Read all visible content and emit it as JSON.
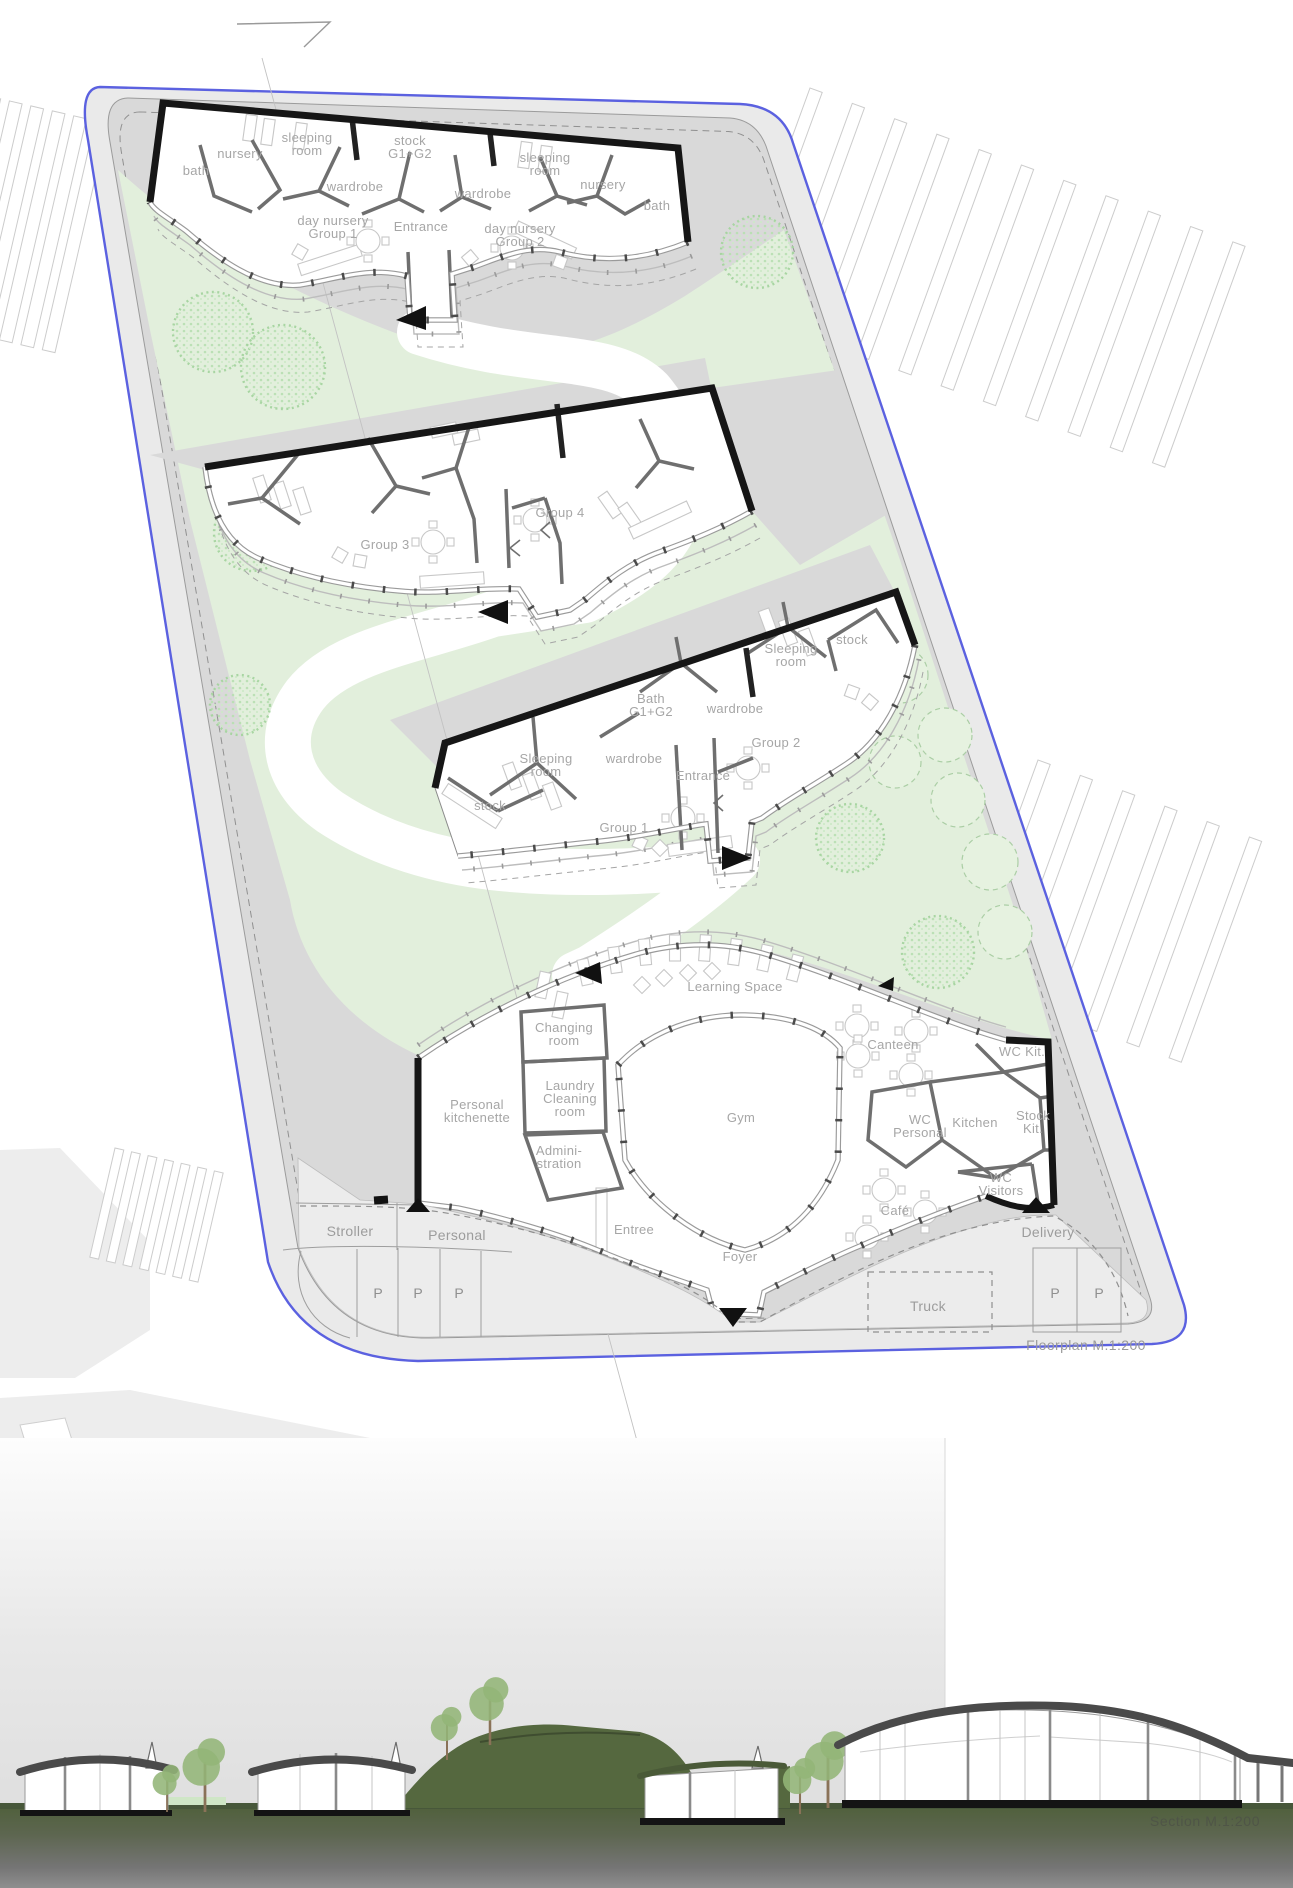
{
  "plan": {
    "scale_label": "Floorplan M.1:200",
    "b1": {
      "bath_l": "bath",
      "nursery_l": "nursery",
      "sleeping_l": "sleeping\nroom",
      "stock": "stock\nG1+G2",
      "wardrobe_l": "wardrobe",
      "entrance": "Entrance",
      "wardrobe_r": "wardrobe",
      "sleeping_r": "sleeping\nroom",
      "nursery_r": "nursery",
      "bath_r": "bath",
      "group1": "day nursery\nGroup 1",
      "group2": "day nursery\nGroup 2"
    },
    "b2": {
      "group3": "Group 3",
      "group4": "Group 4"
    },
    "b3": {
      "stock_top": "stock",
      "sleeping_top": "Sleeping\nroom",
      "bath": "Bath\nG1+G2",
      "wardrobe_top": "wardrobe",
      "group2": "Group 2",
      "sleeping_bottom": "Sleeping\nroom",
      "wardrobe_bottom": "wardrobe",
      "entrance": "Entrance",
      "group1": "Group 1",
      "stock_bottom": "stock"
    },
    "b4": {
      "learning": "Learning Space",
      "changing": "Changing\nroom",
      "canteen": "Canteen",
      "wc_kit": "WC Kit.",
      "personal_kitchenette": "Personal\nkitchenette",
      "laundry": "Laundry\nCleaning\nroom",
      "gym": "Gym",
      "wc_personal": "WC\nPersonal",
      "kitchen": "Kitchen",
      "stock_kit": "Stock\nKit.",
      "administration": "Admini-\nstration",
      "wc_visitors": "WC\nVisitors",
      "cafe": "Café",
      "entree": "Entree",
      "foyer": "Foyer"
    },
    "parking": {
      "stroller": "Stroller",
      "personal": "Personal",
      "delivery": "Delivery",
      "truck": "Truck",
      "stall": "P"
    }
  },
  "section": {
    "scale_label": "Section  M.1:200"
  },
  "colors": {
    "boundary": "#5b61e0",
    "sidewalk": "#eaeaea",
    "plot": "#d9d9d9",
    "green": "#e2efdc",
    "treeDot": "#a5d49f",
    "treeLine": "#abcea5",
    "wall": "#161616",
    "partition": "#6f6f6f",
    "label": "#a6a6a6",
    "apron": "#ececec",
    "roof": "#4a4a4a",
    "groundGreen": "#50603c",
    "groundGray": "#8f8f8f",
    "sectionLabel": "#4f5547"
  }
}
